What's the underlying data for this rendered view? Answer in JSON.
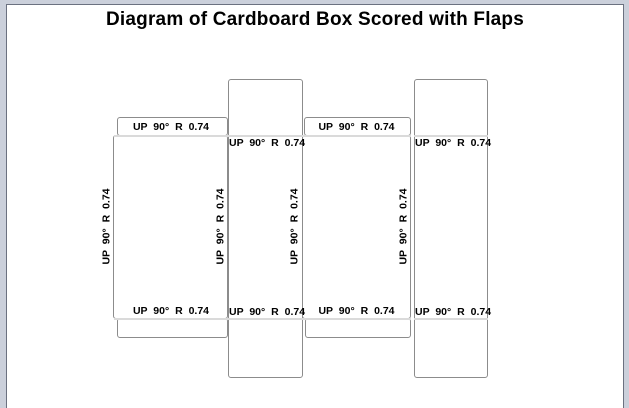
{
  "title": "Diagram of Cardboard Box Scored with Flaps",
  "score_labels": {
    "text": "UP 90° R 0.74",
    "horizontal_top_count": 4,
    "horizontal_bottom_count": 4,
    "vertical_count": 4
  },
  "colors": {
    "window_bg": "#cbd0db",
    "page_bg": "#ffffff",
    "frame_border": "#6b7180",
    "panel_stroke": "#8c8c8c",
    "fold_line": "#dadada",
    "label_color": "#000000"
  }
}
